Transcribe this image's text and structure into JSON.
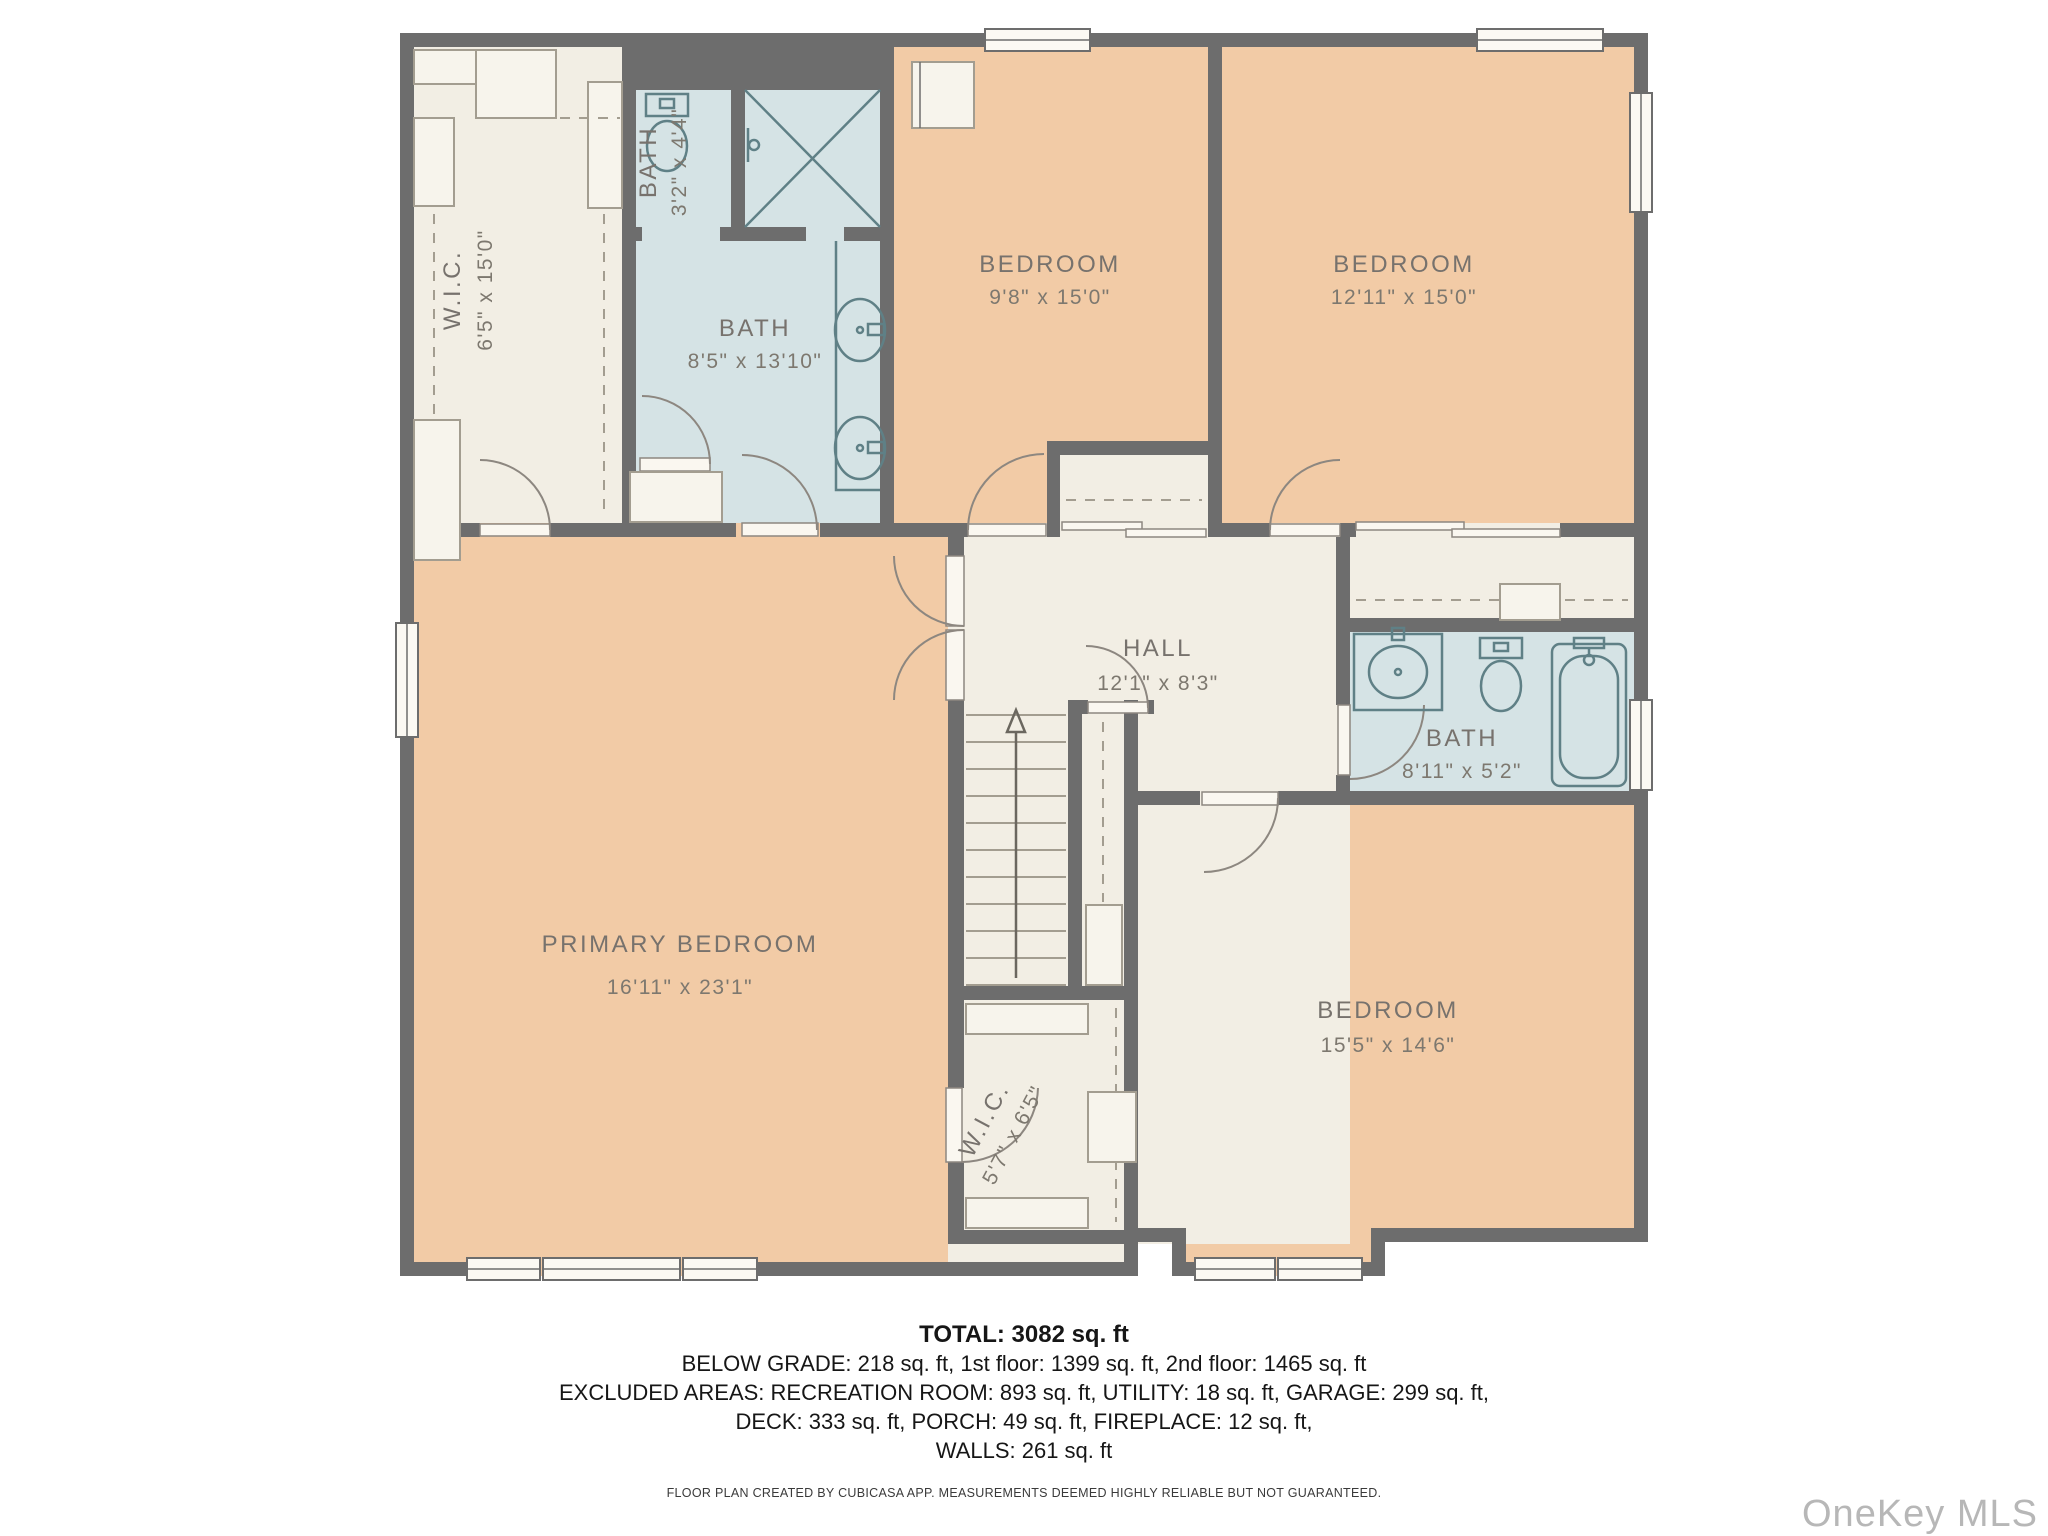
{
  "floor_plan": {
    "rooms": [
      {
        "id": "wic-upper",
        "name": "W.I.C.",
        "dims": "6'5\" x 15'0\""
      },
      {
        "id": "bath-small",
        "name": "BATH",
        "dims": "3'2\" x 4'4\""
      },
      {
        "id": "bath-primary",
        "name": "BATH",
        "dims": "8'5\" x 13'10\""
      },
      {
        "id": "bedroom-top-mid",
        "name": "BEDROOM",
        "dims": "9'8\" x 15'0\""
      },
      {
        "id": "bedroom-top-right",
        "name": "BEDROOM",
        "dims": "12'11\" x 15'0\""
      },
      {
        "id": "hall",
        "name": "HALL",
        "dims": "12'1\" x 8'3\""
      },
      {
        "id": "bath-hall",
        "name": "BATH",
        "dims": "8'11\" x 5'2\""
      },
      {
        "id": "primary-bedroom",
        "name": "PRIMARY BEDROOM",
        "dims": "16'11\" x 23'1\""
      },
      {
        "id": "wic-lower",
        "name": "W.I.C.",
        "dims": "5'7\" x 6'5\""
      },
      {
        "id": "bedroom-bottom",
        "name": "BEDROOM",
        "dims": "15'5\" x 14'6\""
      }
    ],
    "summary": {
      "total": "TOTAL: 3082 sq. ft",
      "lines": [
        "BELOW GRADE: 218 sq. ft, 1st floor: 1399 sq. ft, 2nd floor: 1465 sq. ft",
        "EXCLUDED AREAS: RECREATION ROOM: 893 sq. ft, UTILITY: 18 sq. ft, GARAGE: 299 sq. ft,",
        "DECK: 333 sq. ft, PORCH: 49 sq. ft, FIREPLACE: 12 sq. ft,",
        "WALLS: 261 sq. ft"
      ]
    },
    "disclaimer": "FLOOR PLAN CREATED BY CUBICASA APP. MEASUREMENTS DEEMED HIGHLY RELIABLE BUT NOT GUARANTEED.",
    "watermark": "OneKey MLS",
    "colors": {
      "wall": "#6d6d6d",
      "bedroom_fill": "#f2cba6",
      "bath_fill": "#d5e3e5",
      "closet_hall_fill": "#f2eee4",
      "label_text": "#77726d",
      "summary_text": "#161616",
      "watermark_text": "#b7b7b7"
    }
  }
}
